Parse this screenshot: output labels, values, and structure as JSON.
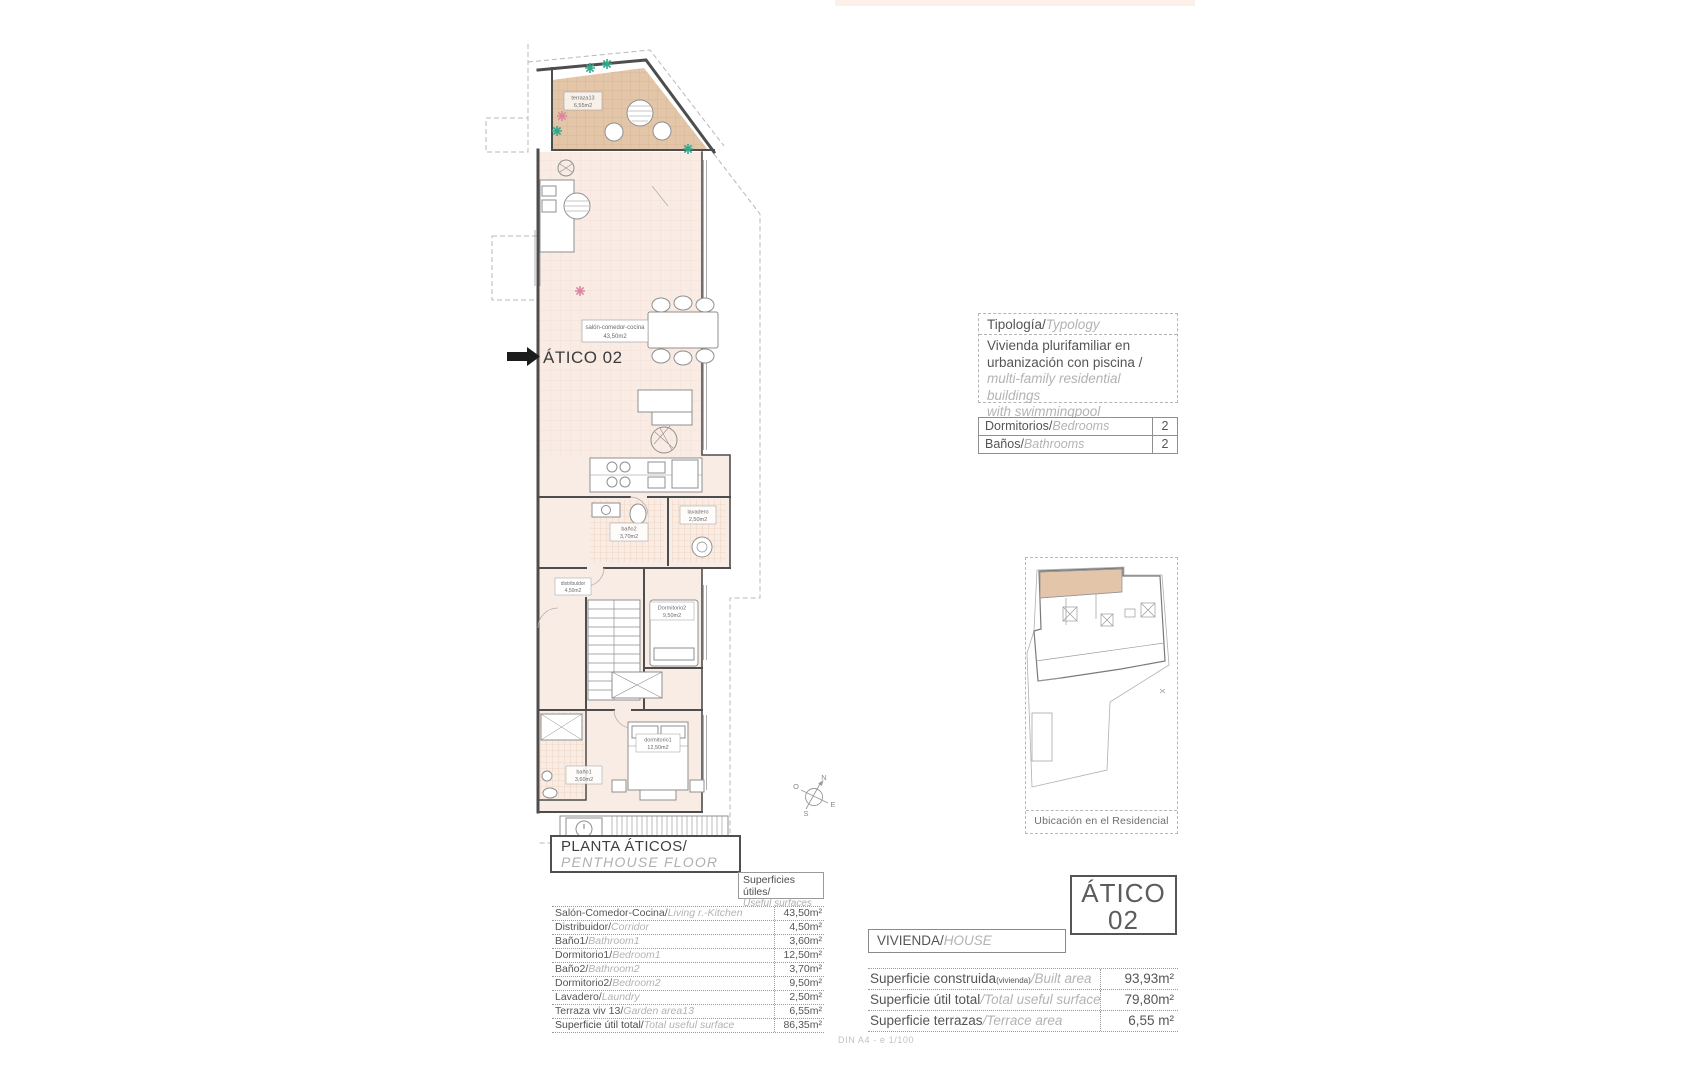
{
  "sheet": {
    "scale_note": "DIN A4 - e 1/100"
  },
  "plan": {
    "pointer_label": "ÁTICO 02",
    "compass": {
      "n": "N",
      "e": "E",
      "s": "S",
      "o": "O"
    },
    "rooms": {
      "terraza": {
        "name": "terraza13",
        "area": "6,55m2"
      },
      "salon": {
        "name": "salón-comedor-cocina",
        "area": "43,50m2"
      },
      "bano2": {
        "name": "baño2",
        "area": "3,70m2"
      },
      "lavadero": {
        "name": "lavadero",
        "area": "2,50m2"
      },
      "distribuidor": {
        "name": "distribuidor",
        "area": "4,50m2"
      },
      "dormitorio2": {
        "name": "Dormitorio2",
        "area": "9,50m2"
      },
      "dormitorio1": {
        "name": "dormitorio1",
        "area": "12,50m2"
      },
      "bano1": {
        "name": "baño1",
        "area": "3,60m2"
      }
    }
  },
  "typology_box": {
    "header_es": "Tipología/",
    "header_en": "Typology",
    "line1_es": "Vivienda plurifamiliar en",
    "line2_es": "urbanización con piscina  /",
    "line1_en": "multi-family residential buildings",
    "line2_en": "with swimmingpool"
  },
  "counts_table": {
    "rows": [
      {
        "es": "Dormitorios/",
        "en": "Bedrooms",
        "value": "2"
      },
      {
        "es": "Baños/",
        "en": "Bathrooms",
        "value": "2"
      }
    ]
  },
  "location_box": {
    "caption": "Ubicación en el Residencial"
  },
  "title_block": {
    "title_es": "PLANTA ÁTICOS/",
    "title_en": "PENTHOUSE  FLOOR",
    "surfaces_es": "Superficies útiles/",
    "surfaces_en": "Useful surfaces"
  },
  "areas_table": {
    "rows": [
      {
        "es": "Salón-Comedor-Cocina/",
        "en": "Living r.-Kitchen",
        "value": "43,50m²"
      },
      {
        "es": "Distribuidor/",
        "en": "Corridor",
        "value": "4,50m²"
      },
      {
        "es": "Baño1/",
        "en": "Bathroom1",
        "value": "3,60m²"
      },
      {
        "es": "Dormitorio1/",
        "en": "Bedroom1",
        "value": "12,50m²"
      },
      {
        "es": "Baño2/",
        "en": "Bathroom2",
        "value": "3,70m²"
      },
      {
        "es": "Dormitorio2/",
        "en": "Bedroom2",
        "value": "9,50m²"
      },
      {
        "es": "Lavadero/",
        "en": "Laundry",
        "value": "2,50m²"
      },
      {
        "es": "Terraza viv 13/",
        "en": "Garden area13",
        "value": "6,55m²"
      },
      {
        "es": "Superficie útil total/",
        "en": "Total useful surface",
        "value": "86,35m²"
      }
    ]
  },
  "unit_label": {
    "line1": "ÁTICO",
    "line2": "02"
  },
  "house_block": {
    "header_es": "VIVIENDA/",
    "header_en": "HOUSE",
    "rows": [
      {
        "es": "Superficie construida",
        "paren": "(vivienda)",
        "en": "/Built area",
        "value": "93,93m²"
      },
      {
        "es": "Superficie útil total",
        "paren": "",
        "en": "/Total useful surfaces",
        "value": "79,80m²"
      },
      {
        "es": "Superficie terrazas",
        "paren": "",
        "en": "/Terrace area",
        "value": "6,55 m²"
      }
    ]
  }
}
